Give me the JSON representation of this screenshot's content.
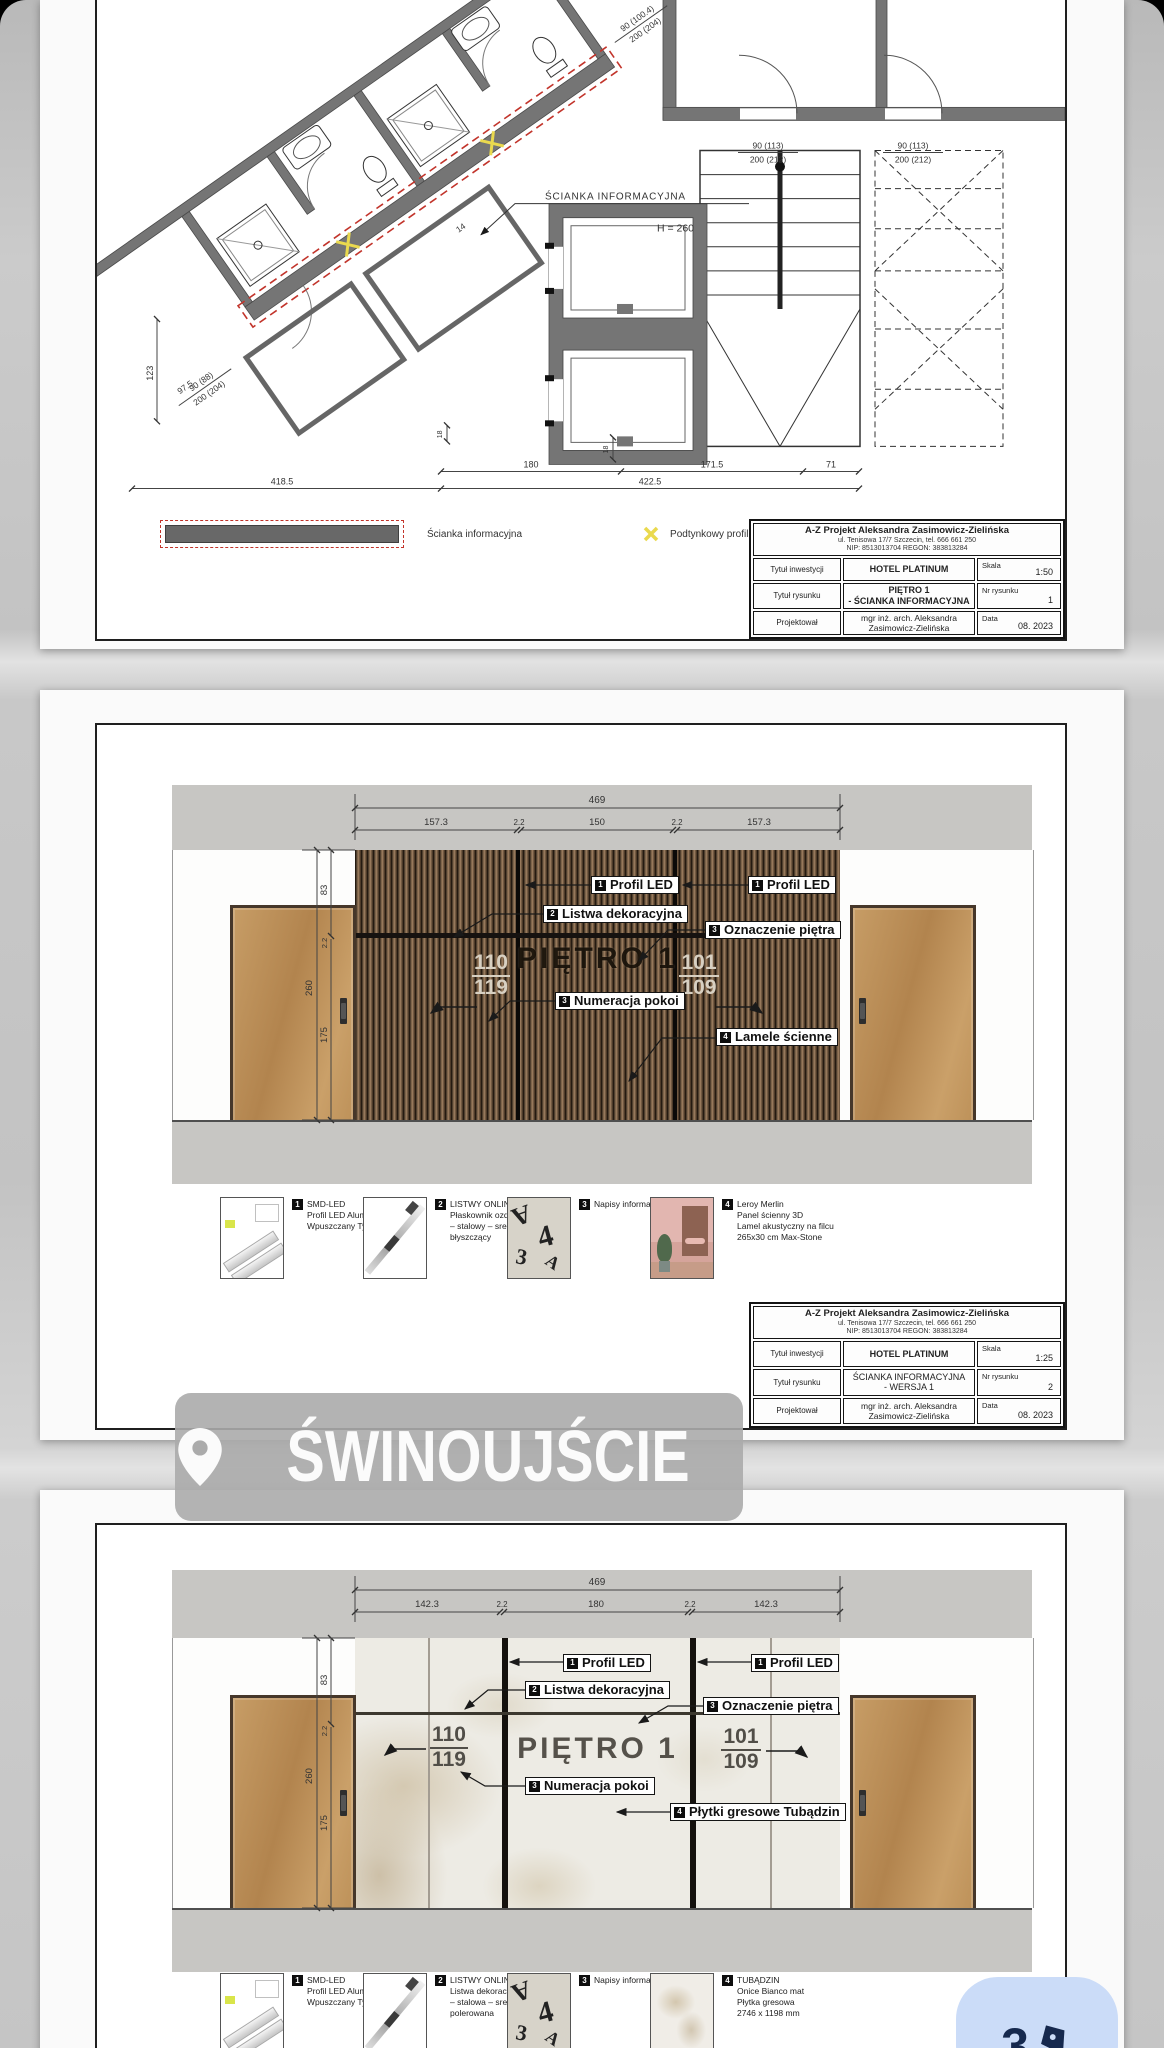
{
  "overlay": {
    "location": "ŚWINOUJŚCIE",
    "note": "3"
  },
  "letters_thumb": {
    "g1": "A",
    "g2": "4",
    "g3": "3",
    "g4": "A"
  },
  "sheet1": {
    "plan": {
      "wall_label": "ŚCIANKA INFORMACYJNA",
      "wall_height": "H = 260",
      "door_a_w": "90 (113)",
      "door_a_h": "200 (212)",
      "door_b_w": "90 (113)",
      "door_b_h": "200 (212)",
      "diag_door_a_w": "90 (88)",
      "diag_door_a_h": "200 (204)",
      "diag_door_b_w": "90 (100.4)",
      "diag_door_b_h": "200 (204)",
      "dim_180": "180",
      "dim_1715": "171.5",
      "dim_71": "71",
      "dim_4185": "418.5",
      "dim_4225": "422.5",
      "dim_123": "123",
      "dim_975": "97.5",
      "dim_18": "18",
      "dim_14": "14"
    },
    "legend": {
      "wall": "Ścianka informacyjna",
      "led": "Podtynkowy profil LED"
    },
    "titleblock": {
      "company": "A-Z Projekt Aleksandra Zasimowicz-Zielińska",
      "address": "ul. Tenisowa 17/7 Szczecin, tel. 666 661 250",
      "ids": "NIP: 8513013704 REGON: 383813284",
      "r1_label": "Tytuł inwestycji",
      "r1_value": "HOTEL PLATINUM",
      "r1_meta": "Skala",
      "r1_meta_value": "1:50",
      "r2_label": "Tytuł rysunku",
      "r2_value1": "PIĘTRO 1",
      "r2_value2": "- ŚCIANKA INFORMACYJNA",
      "r2_meta": "Nr rysunku",
      "r2_meta_value": "1",
      "r3_label": "Projektował",
      "r3_value1": "mgr inż. arch. Aleksandra",
      "r3_value2": "Zasimowicz-Zielińska",
      "r3_meta": "Data",
      "r3_meta_value": "08. 2023"
    }
  },
  "sheet2": {
    "dims": {
      "total": "469",
      "s1": "157.3",
      "s2": "2.2",
      "s3": "150",
      "s4": "2.2",
      "s5": "157.3",
      "v260": "260",
      "v83": "83",
      "v22": "2.2",
      "v175": "175"
    },
    "callouts": {
      "led_n": "1",
      "led": "Profil LED",
      "listwa_n": "2",
      "listwa": "Listwa dekoracyjna",
      "ozn_n": "3",
      "ozn": "Oznaczenie piętra",
      "num_n": "3",
      "num": "Numeracja pokoi",
      "lamele_n": "4",
      "lamele": "Lamele ścienne"
    },
    "wall": {
      "floor": "PIĘTRO 1",
      "left_a": "110",
      "left_b": "119",
      "right_a": "101",
      "right_b": "109"
    },
    "materials": [
      {
        "num": "1",
        "l1": "SMD-LED",
        "l2": "Profil LED Aluminiowy Biały",
        "l3": "Wpuszczany Typ Z",
        "l4": ""
      },
      {
        "num": "2",
        "l1": "LISTWY ONLINE",
        "l2": "Płaskownik ozdobny",
        "l3": "– stalowy – srebrny",
        "l4": "błyszczący"
      },
      {
        "num": "3",
        "l1": "Napisy informacyjne",
        "l2": "",
        "l3": "",
        "l4": ""
      },
      {
        "num": "4",
        "l1": "Leroy Merlin",
        "l2": "Panel ścienny 3D",
        "l3": "Lamel akustyczny na filcu",
        "l4": "265x30 cm Max-Stone"
      }
    ],
    "titleblock": {
      "company": "A-Z Projekt Aleksandra Zasimowicz-Zielińska",
      "address": "ul. Tenisowa 17/7 Szczecin, tel. 666 661 250",
      "ids": "NIP: 8513013704 REGON: 383813284",
      "r1_label": "Tytuł inwestycji",
      "r1_value": "HOTEL PLATINUM",
      "r1_meta": "Skala",
      "r1_meta_value": "1:25",
      "r2_label": "Tytuł rysunku",
      "r2_value1": "ŚCIANKA INFORMACYJNA",
      "r2_value2": "- WERSJA 1",
      "r2_meta": "Nr rysunku",
      "r2_meta_value": "2",
      "r3_label": "Projektował",
      "r3_value1": "mgr inż. arch. Aleksandra",
      "r3_value2": "Zasimowicz-Zielińska",
      "r3_meta": "Data",
      "r3_meta_value": "08. 2023"
    }
  },
  "sheet3": {
    "dims": {
      "total": "469",
      "s1": "142.3",
      "s2": "2.2",
      "s3": "180",
      "s4": "2.2",
      "s5": "142.3",
      "v260": "260",
      "v83": "83",
      "v22": "2.2",
      "v175": "175"
    },
    "callouts": {
      "led_n": "1",
      "led": "Profil LED",
      "listwa_n": "2",
      "listwa": "Listwa dekoracyjna",
      "ozn_n": "3",
      "ozn": "Oznaczenie piętra",
      "num_n": "3",
      "num": "Numeracja pokoi",
      "plytki_n": "4",
      "plytki": "Płytki gresowe Tubądzin"
    },
    "wall": {
      "floor": "PIĘTRO 1",
      "left_a": "110",
      "left_b": "119",
      "right_a": "101",
      "right_b": "109"
    },
    "materials": [
      {
        "num": "1",
        "l1": "SMD-LED",
        "l2": "Profil LED Aluminiowy Biały",
        "l3": "Wpuszczany Typ Z",
        "l4": ""
      },
      {
        "num": "2",
        "l1": "LISTWY ONLINE",
        "l2": "Listwa dekoracyjna C",
        "l3": "– stalowa – srebrna",
        "l4": "polerowana"
      },
      {
        "num": "3",
        "l1": "Napisy informacyjne",
        "l2": "",
        "l3": "",
        "l4": ""
      },
      {
        "num": "4",
        "l1": "TUBĄDZIN",
        "l2": "Onice Bianco mat",
        "l3": "Płytka gresowa",
        "l4": "2746 x 1198 mm"
      }
    ]
  }
}
